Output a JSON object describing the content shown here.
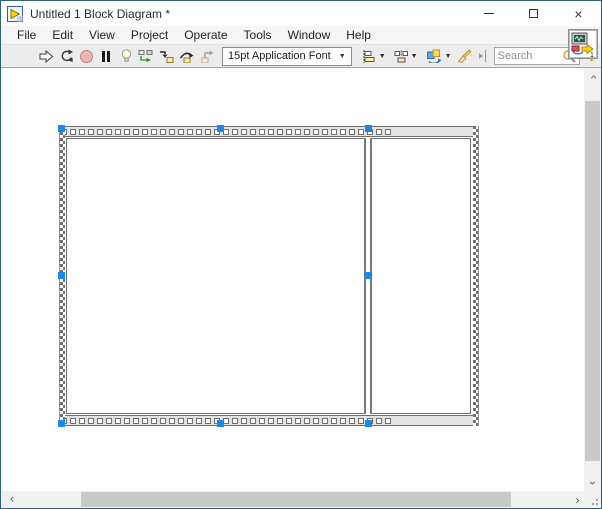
{
  "window": {
    "title": "Untitled 1 Block Diagram *"
  },
  "menu": {
    "items": [
      "File",
      "Edit",
      "View",
      "Project",
      "Operate",
      "Tools",
      "Window",
      "Help"
    ]
  },
  "toolbar": {
    "font_selector": {
      "value": "15pt Application Font"
    },
    "search": {
      "placeholder": "Search",
      "value": ""
    },
    "help": "?"
  },
  "vi_icon": {
    "badge": "1"
  },
  "glyphs": {
    "dropdown": "▼",
    "close": "×",
    "scroll_chevron": "›"
  },
  "diagram": {
    "structure": {
      "type": "flat-sequence-structure",
      "frames": 2,
      "selected": true,
      "selection_handles": 8
    }
  },
  "icons": {
    "run": "hollow-right-arrow",
    "run-continuously": "circular-arrows",
    "abort": "red-circle-disabled",
    "pause": "double-black-bars",
    "highlight-execution": "light-bulb",
    "retain-wire-values": "squares-with-green-arrow",
    "step-into": "arrow-down-into-yellow-node",
    "step-over": "arc-arrow-over-yellow-node",
    "step-out": "gray-arrow-out-of-node",
    "align-objects": "align-boxes-dropdown",
    "distribute-objects": "distribute-boxes-dropdown",
    "reorder": "colored-stack-circular-arrow-dropdown",
    "clean-up-diagram": "broom",
    "search": "magnifier",
    "help": "question-mark",
    "vi": "monitor-with-waveform"
  },
  "colors": {
    "window_border": "#2f6577",
    "selection_handle": "#1b87e6",
    "abort_disabled": "#eab6b6",
    "step_node_yellow": "#ffe9a0",
    "toolbar_bg": "#ececec"
  }
}
